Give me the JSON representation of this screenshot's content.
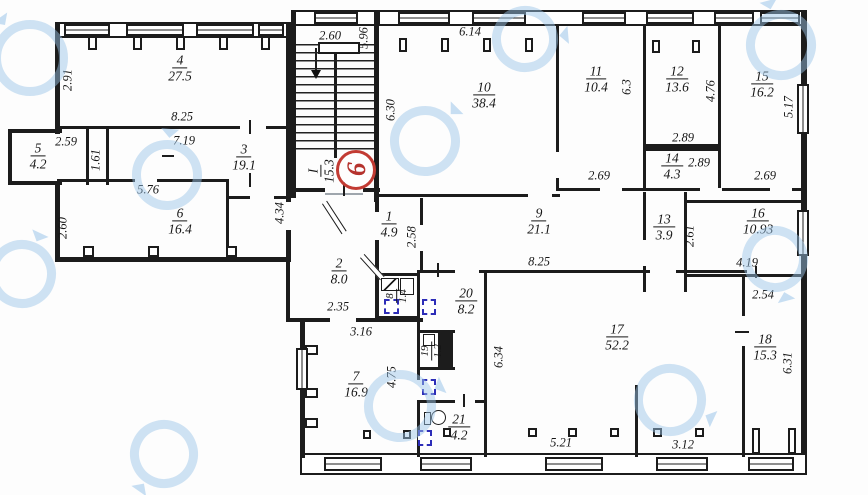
{
  "drawing": {
    "type": "apartment-floor-plan",
    "stamp_number": "9",
    "colors": {
      "wall": "#1c1c1c",
      "stamp_red": "#b5332e",
      "vent_blue": "#2d2db8",
      "watermark_blue": "#9ac4e9"
    },
    "icons": {
      "stairs_direction": "arrow-down",
      "toilet": "toilet-bowl",
      "vent": "dashed-vent-shaft",
      "watermark": "circular-logo-watermark"
    }
  },
  "rooms": {
    "r1": {
      "num": "1",
      "area": "4.9"
    },
    "r2": {
      "num": "2",
      "area": "8.0"
    },
    "r3": {
      "num": "3",
      "area": "19.1"
    },
    "r4": {
      "num": "4",
      "area": "27.5"
    },
    "r5": {
      "num": "5",
      "area": "4.2"
    },
    "r6": {
      "num": "6",
      "area": "16.4"
    },
    "r7": {
      "num": "7",
      "area": "16.9"
    },
    "r8": {
      "num": "8",
      "area": "1.4"
    },
    "r9": {
      "num": "9",
      "area": "21.1"
    },
    "r10": {
      "num": "10",
      "area": "38.4"
    },
    "r11": {
      "num": "11",
      "area": "10.4"
    },
    "r12": {
      "num": "12",
      "area": "13.6"
    },
    "r13": {
      "num": "13",
      "area": "3.9"
    },
    "r14": {
      "num": "14",
      "area": "4.3"
    },
    "r15": {
      "num": "15",
      "area": "16.2"
    },
    "r16": {
      "num": "16",
      "area": "10.93"
    },
    "r17": {
      "num": "17",
      "area": "52.2"
    },
    "r18": {
      "num": "18",
      "area": "15.3"
    },
    "r19": {
      "num": "19",
      "area": "1.2"
    },
    "r20": {
      "num": "20",
      "area": "8.2"
    },
    "r21": {
      "num": "21",
      "area": "4.2"
    },
    "stair": {
      "num": "I",
      "area": "15.3"
    }
  },
  "dims": {
    "d291": "2.91",
    "d825a": "8.25",
    "d259": "2.59",
    "d161": "1.61",
    "d719": "7.19",
    "d576": "5.76",
    "d260a": "2.60",
    "d434": "4.34",
    "d260b": "2.60",
    "d596": "5.96",
    "d614": "6.14",
    "d630": "6.30",
    "d63": "6.3",
    "d476": "4.76",
    "d517": "5.17",
    "d289a": "2.89",
    "d289b": "2.89",
    "d269a": "2.69",
    "d269b": "2.69",
    "d258": "2.58",
    "d825b": "8.25",
    "d261": "2.61",
    "d419": "4.19",
    "d235": "2.35",
    "d316": "3.16",
    "d475": "4.75",
    "d634": "6.34",
    "d521": "5.21",
    "d312": "3.12",
    "d254": "2.54",
    "d631": "6.31"
  }
}
